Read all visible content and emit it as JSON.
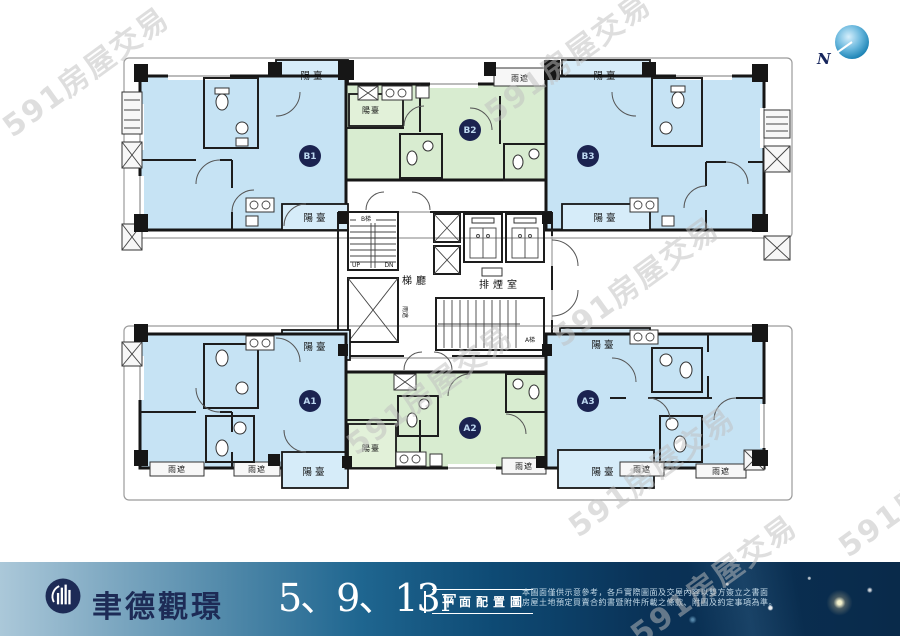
{
  "watermark": {
    "text": "591房屋交易"
  },
  "plan": {
    "compass_label": "N",
    "labels": {
      "balcony": "陽臺",
      "rain_cover": "雨遮",
      "stair_hall": "梯廳",
      "smoke_room": "排煙室",
      "stair_a": "A梯",
      "stair_b": "B梯",
      "up": "UP",
      "dn": "DN"
    },
    "units": {
      "b1": {
        "label": "B1"
      },
      "b2": {
        "label": "B2"
      },
      "b3": {
        "label": "B3"
      },
      "a1": {
        "label": "A1"
      },
      "a2": {
        "label": "A2"
      },
      "a3": {
        "label": "A3"
      }
    },
    "colors": {
      "unit_blue": "#c6e3f4",
      "unit_green": "#d8ecd0",
      "balcony_blue": "#d6ecf9",
      "balcony_green": "#e2f1d9",
      "badge": "#1b2350"
    }
  },
  "banner": {
    "brand": "聿德觀璟",
    "floors": "5、9、13",
    "floor_suffix": "F",
    "plan_type": "平面配置圖",
    "disclaimer_line1": "本圖面僅供示意參考，各戶實際圖面及交屋內容以雙方簽立之書面",
    "disclaimer_line2": "房屋土地預定買賣合約書暨附件所載之條款、附圖及約定事項為準。"
  }
}
